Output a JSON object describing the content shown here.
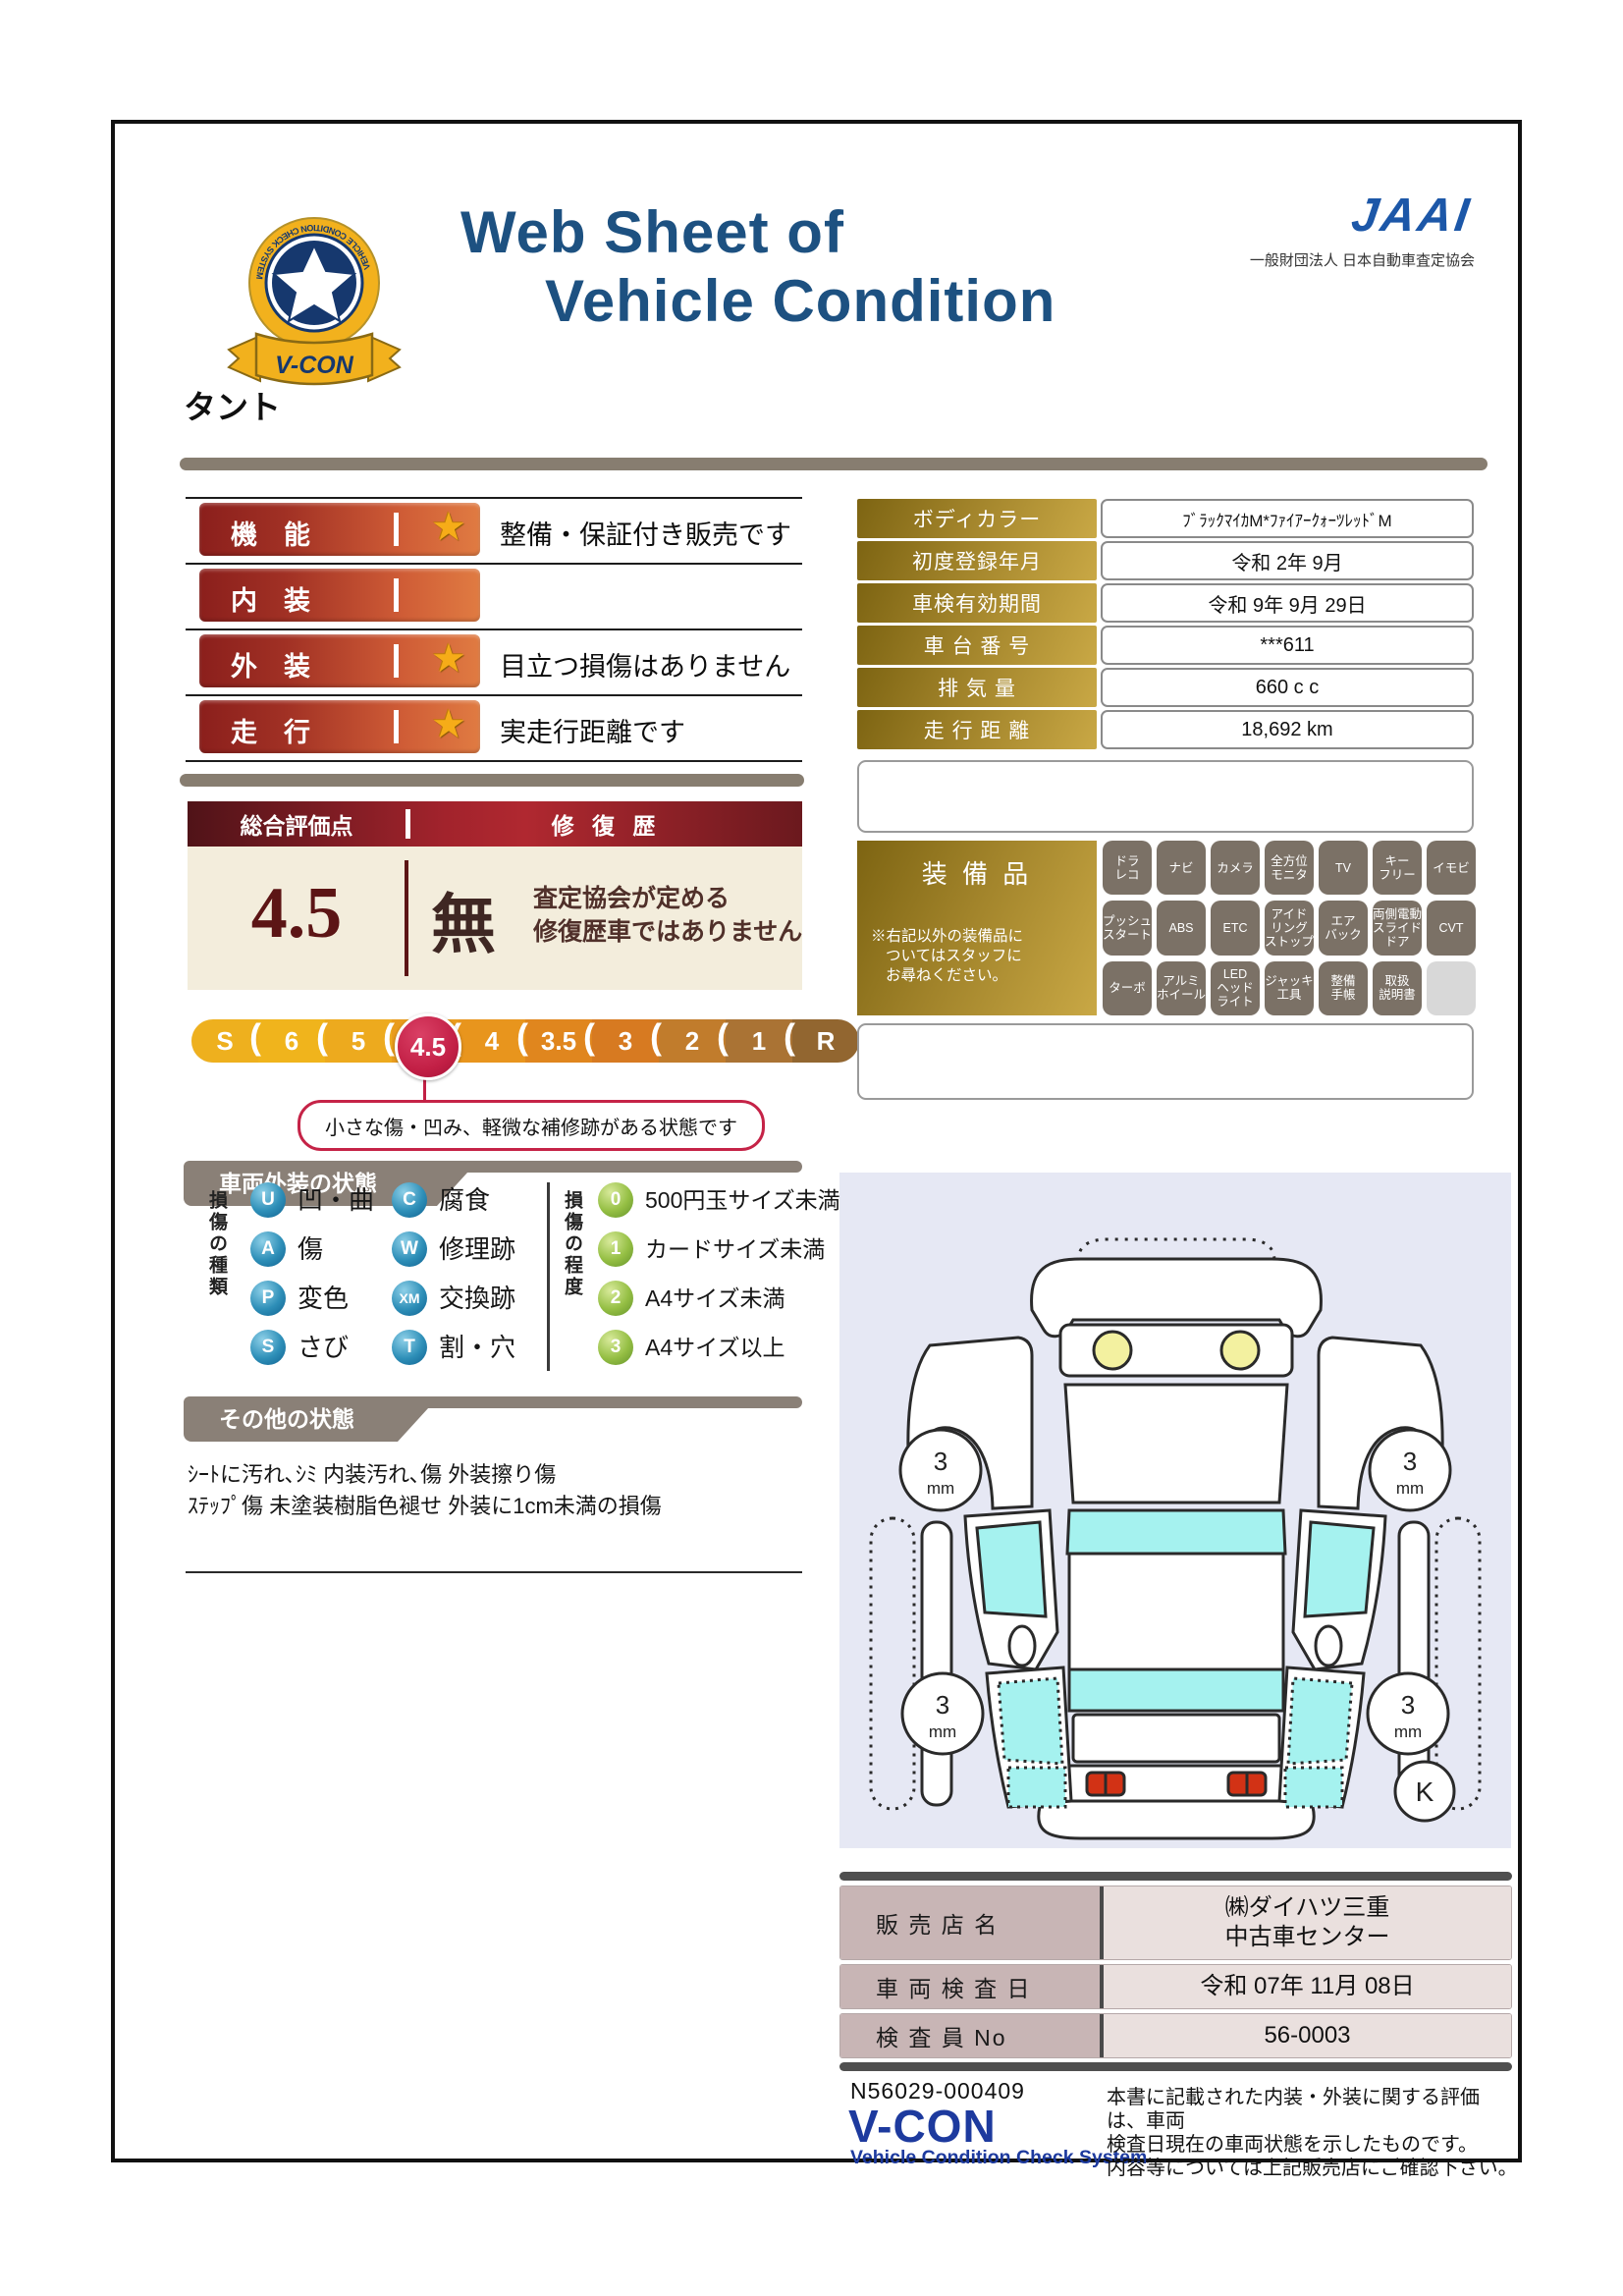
{
  "header": {
    "title_line1": "Web Sheet of",
    "title_line2": "Vehicle Condition",
    "jaai_logo": "JAAI",
    "jaai_subtitle": "一般財団法人 日本自動車査定協会",
    "badge": {
      "brand": "V-CON",
      "ring_text": "VEHICLE CONDITION CHECK SYSTEM",
      "star_text": "JAAI"
    }
  },
  "vehicle_name": "タント",
  "ratings": [
    {
      "label": "機　能",
      "star": true,
      "description": "整備・保証付き販売です"
    },
    {
      "label": "内　装",
      "star": false,
      "description": ""
    },
    {
      "label": "外　装",
      "star": true,
      "description": "目立つ損傷はありません"
    },
    {
      "label": "走　行",
      "star": true,
      "description": "実走行距離です"
    }
  ],
  "info_table": {
    "rows": [
      {
        "label": "ボディカラー",
        "value": "ﾌﾞﾗｯｸﾏｲｶM*ﾌｧｲｱｰｸｫｰﾂﾚｯﾄﾞM"
      },
      {
        "label": "初度登録年月",
        "value": "令和 2年 9月"
      },
      {
        "label": "車検有効期間",
        "value": "令和 9年 9月 29日"
      },
      {
        "label": "車 台 番 号",
        "value": "***611"
      },
      {
        "label": "排  気  量",
        "value": "660 c c"
      },
      {
        "label": "走 行 距 離",
        "value": "18,692 km"
      }
    ]
  },
  "assessment": {
    "header_left": "総合評価点",
    "header_right": "修 復 歴",
    "score": "4.5",
    "repair_none": "無",
    "repair_note_line1": "査定協会が定める",
    "repair_note_line2": "修復歴車ではありません",
    "scale": [
      "S",
      "6",
      "5",
      "4.5",
      "4",
      "3.5",
      "3",
      "2",
      "1",
      "R"
    ],
    "selected": "4.5",
    "callout": "小さな傷・凹み、軽微な補修跡がある状態です"
  },
  "equipment": {
    "title": "装 備 品",
    "note_lines": [
      "※右記以外の装備品に",
      "ついてはスタッフに",
      "お尋ねください。"
    ],
    "items": [
      "ドラ\nレコ",
      "ナビ",
      "カメラ",
      "全方位\nモニタ",
      "TV",
      "キー\nフリー",
      "イモビ",
      "プッシュ\nスタート",
      "ABS",
      "ETC",
      "アイド\nリング\nストップ",
      "エア\nバック",
      "両側電動\nスライド\nドア",
      "CVT",
      "ターボ",
      "アルミ\nホイール",
      "LED\nヘッド\nライト",
      "ジャッキ\n工具",
      "整備\n手帳",
      "取扱\n説明書",
      ""
    ]
  },
  "exterior_section": {
    "title": "車両外装の状態",
    "type_legend_title": "損傷の種類",
    "types": [
      {
        "code": "U",
        "label": "凹・曲"
      },
      {
        "code": "A",
        "label": "傷"
      },
      {
        "code": "P",
        "label": "変色"
      },
      {
        "code": "S",
        "label": "さび"
      },
      {
        "code": "C",
        "label": "腐食"
      },
      {
        "code": "W",
        "label": "修理跡"
      },
      {
        "code": "XM",
        "label": "交換跡"
      },
      {
        "code": "T",
        "label": "割・穴"
      }
    ],
    "degree_legend_title": "損傷の程度",
    "degrees": [
      {
        "code": "0",
        "label": "500円玉サイズ未満"
      },
      {
        "code": "1",
        "label": "カードサイズ未満"
      },
      {
        "code": "2",
        "label": "A4サイズ未満"
      },
      {
        "code": "3",
        "label": "A4サイズ以上"
      }
    ]
  },
  "other_section": {
    "title": "その他の状態",
    "lines": "ｼｰﾄに汚れ､ｼﾐ 内装汚れ､傷 外装擦り傷\nｽﾃｯﾌﾟ傷 未塗装樹脂色褪せ 外装に1cm未満の損傷"
  },
  "diagram": {
    "tread_value": "3",
    "tread_unit": "mm",
    "corner_mark": "K"
  },
  "dealer_table": {
    "rows": [
      {
        "label": "販 売 店 名",
        "value": "㈱ダイハツ三重\n中古車センター"
      },
      {
        "label": "車 両 検 査 日",
        "value": "令和 07年 11月 08日"
      },
      {
        "label": "検 査 員 No",
        "value": "56-0003"
      }
    ]
  },
  "footer": {
    "doc_number": "N56029-000409",
    "brand": "V-CON",
    "brand_subtitle": "Vehicle Condition Check System",
    "disclaimer": "本書に記載された内装・外装に関する評価は、車両\n検査日現在の車両状態を示したものです。\n内容等については上記販売店にご確認下さい。"
  },
  "colors": {
    "accent_red": "#c52347",
    "gold": "#c9a845",
    "navy": "#1d5181",
    "banner_gray": "#8a8077"
  }
}
